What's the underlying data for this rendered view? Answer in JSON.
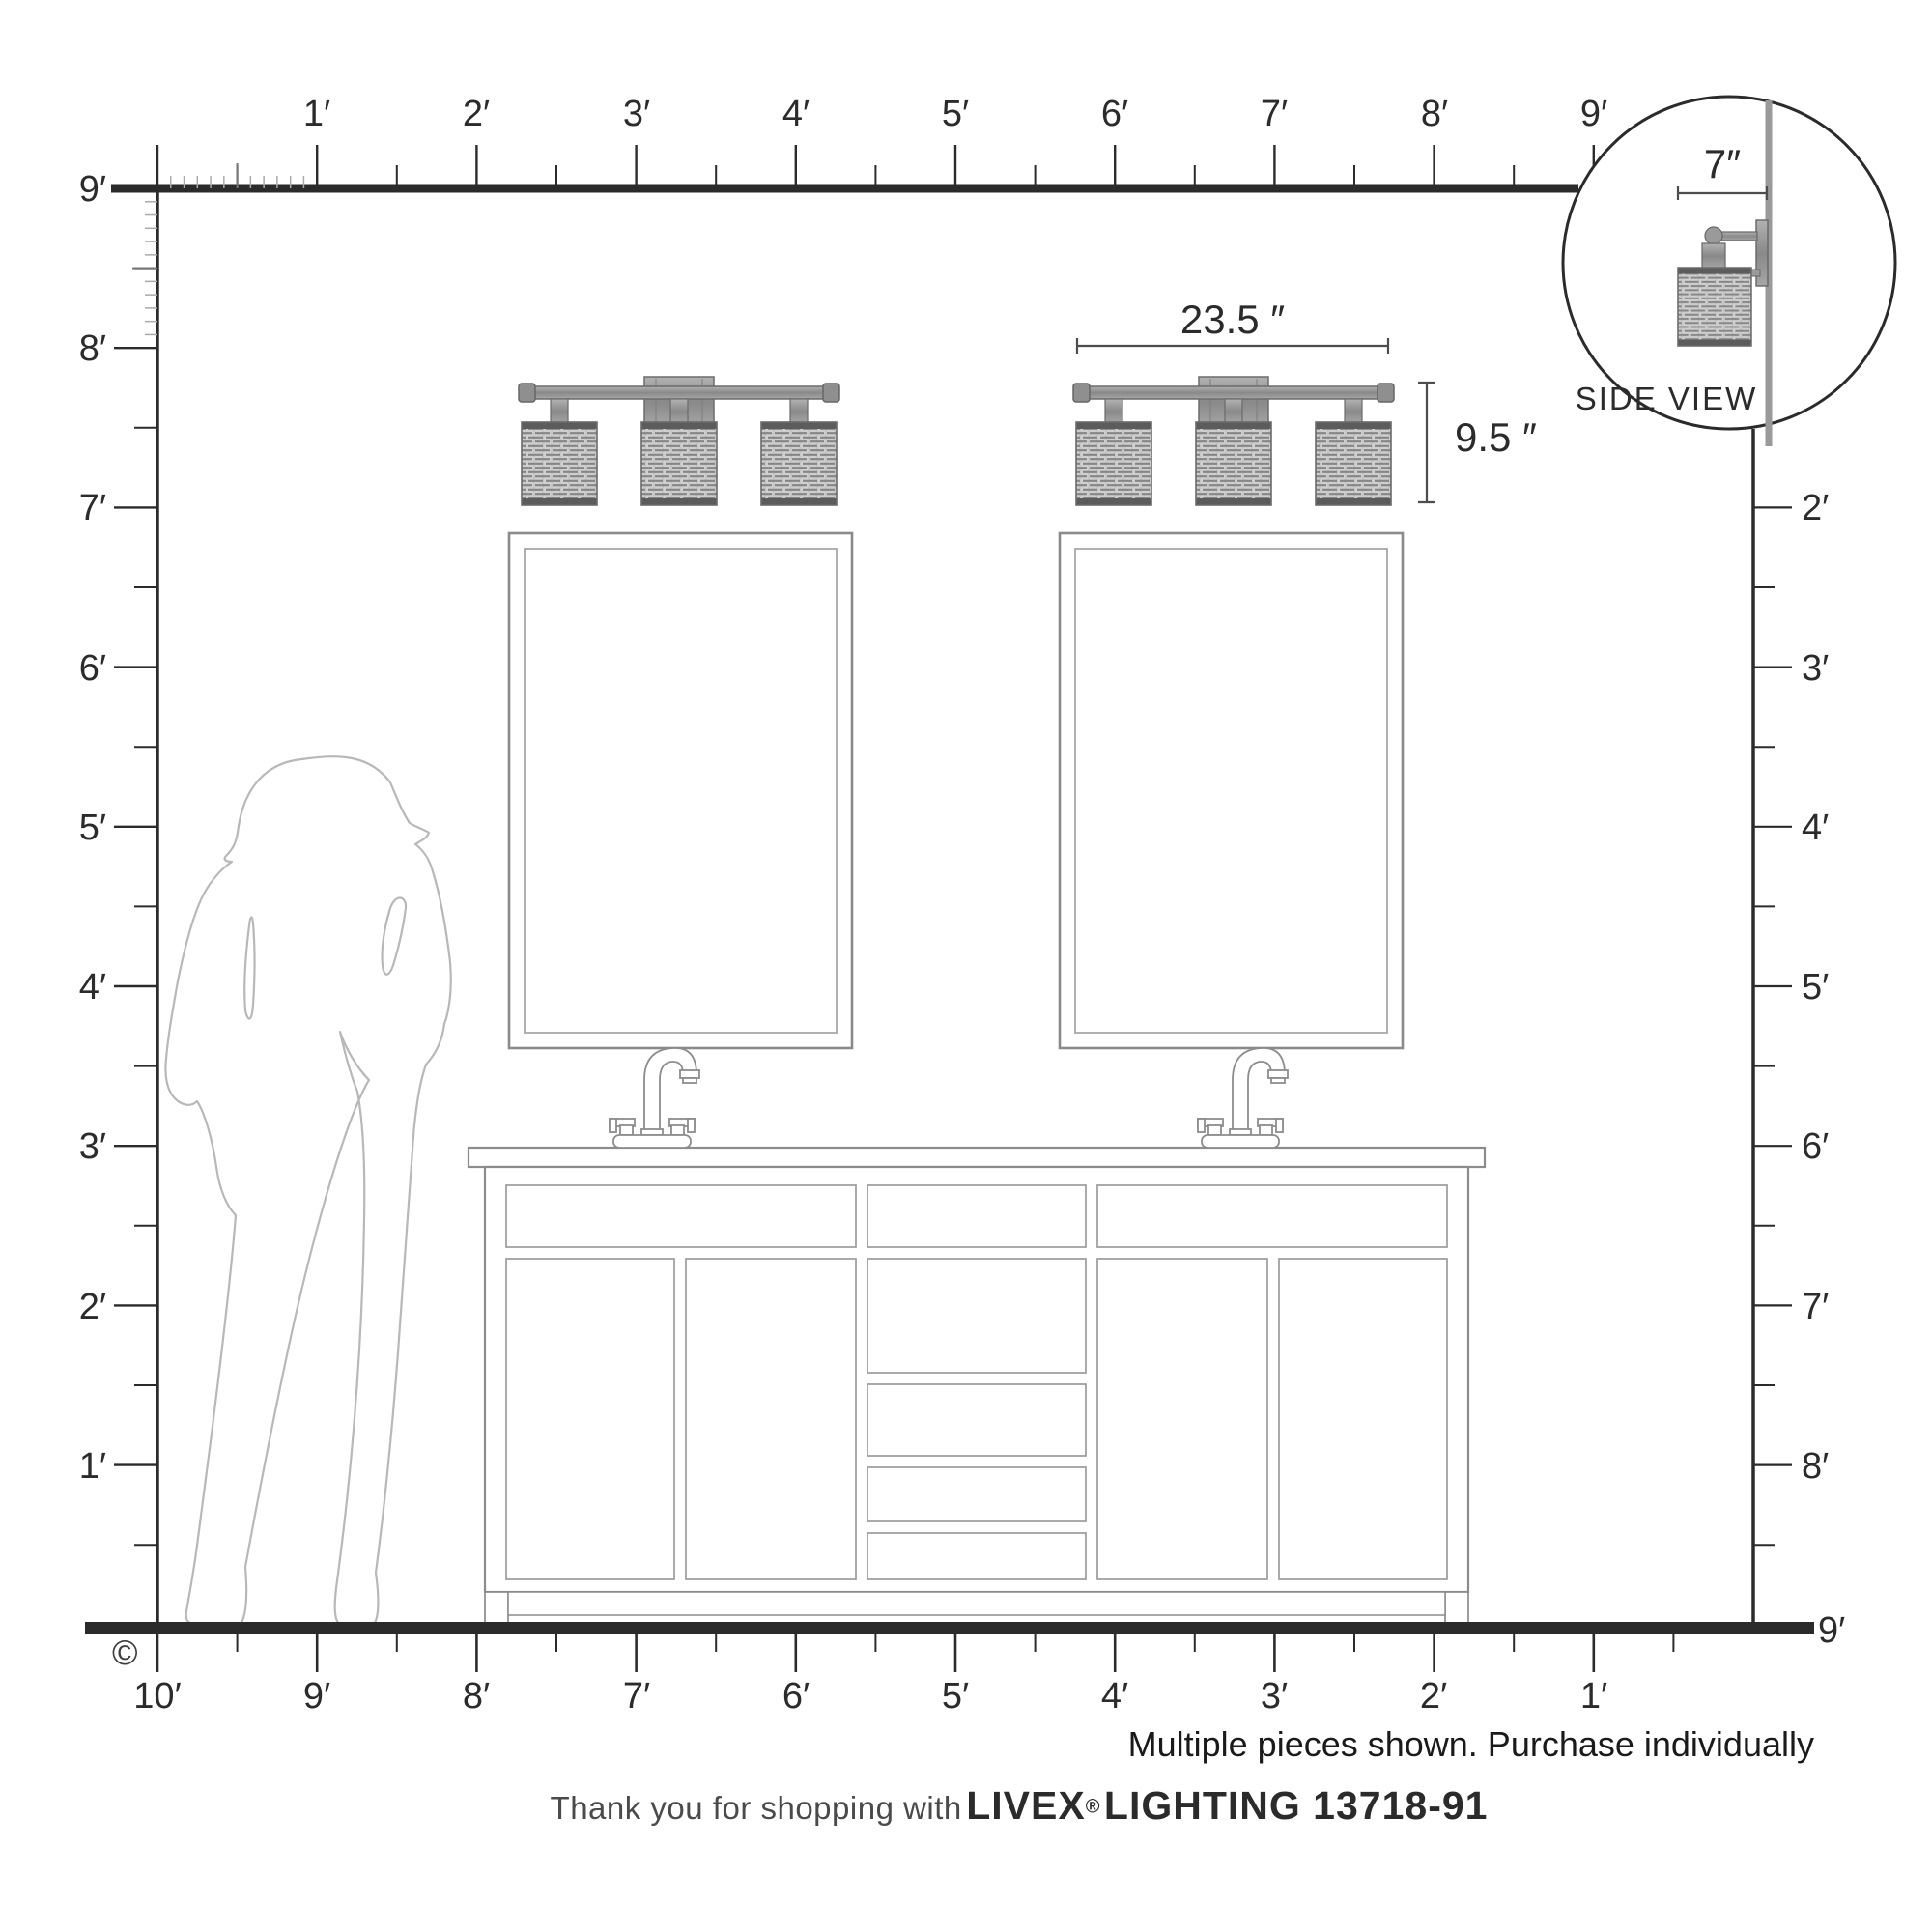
{
  "rulers": {
    "top": [
      "1′",
      "2′",
      "3′",
      "4′",
      "5′",
      "6′",
      "7′",
      "8′",
      "9′"
    ],
    "left": [
      "9′",
      "8′",
      "7′",
      "6′",
      "5′",
      "4′",
      "3′",
      "2′",
      "1′"
    ],
    "right": [
      "2′",
      "3′",
      "4′",
      "5′",
      "6′",
      "7′",
      "8′",
      "9′"
    ],
    "bottom": [
      "10′",
      "9′",
      "8′",
      "7′",
      "6′",
      "5′",
      "4′",
      "3′",
      "2′",
      "1′"
    ]
  },
  "dimensions": {
    "width": "23.5 ″",
    "height": "9.5 ″",
    "depth": "7″"
  },
  "inset": {
    "label": "SIDE VIEW"
  },
  "notes": {
    "purchase": "Multiple pieces shown. Purchase individually",
    "copyright": "©"
  },
  "footer": {
    "prefix": "Thank you for shopping with",
    "brand": "LIVEX",
    "registered": "®",
    "suffix": "LIGHTING 13718-91"
  },
  "colors": {
    "ink": "#2b2b2b",
    "outline_gray": "#8c8c8c",
    "silhouette_gray": "#b8b8b8",
    "metal_gray": "#9a9a9a",
    "shade_gray": "#cfcfcf"
  }
}
